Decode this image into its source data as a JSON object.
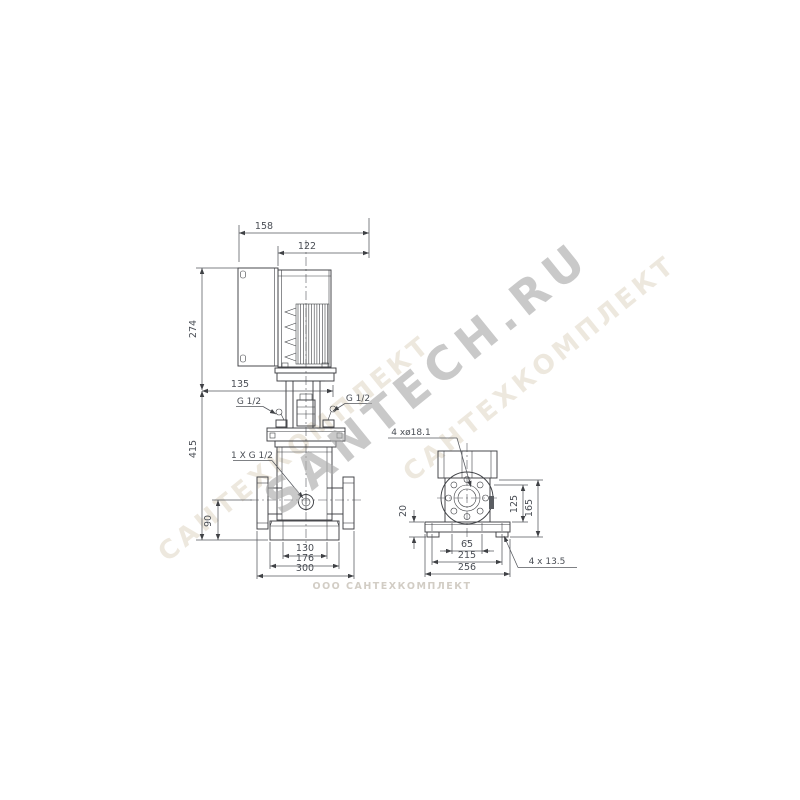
{
  "watermarks": {
    "main_diagonal": "SANTECH.RU",
    "faint_diagonal": "САНТЕХКОМПЛЕКТ",
    "bottom_line": "ООО САНТЕХКОМПЛЕКТ"
  },
  "front_view": {
    "dim_total_depth": "158",
    "dim_motor_width": "122",
    "dim_motor_height": "274",
    "dim_head_offset": "135",
    "dim_pump_height": "415",
    "dim_port_height": "90",
    "dim_base_inner": "130",
    "dim_base_outer": "176",
    "dim_flange_span": "300",
    "label_vent_left": "G 1/2",
    "label_vent_right": "G 1/2",
    "label_drain": "1 X G 1/2"
  },
  "side_view": {
    "dim_plate_thickness": "20",
    "dim_port_center": "125",
    "dim_base_total": "165",
    "dim_feet_spacing": "65",
    "dim_hole_spacing": "215",
    "dim_plate_width": "256",
    "callout_flange_holes": "4 xø18.1",
    "callout_base_holes": "4 x 13.5"
  }
}
